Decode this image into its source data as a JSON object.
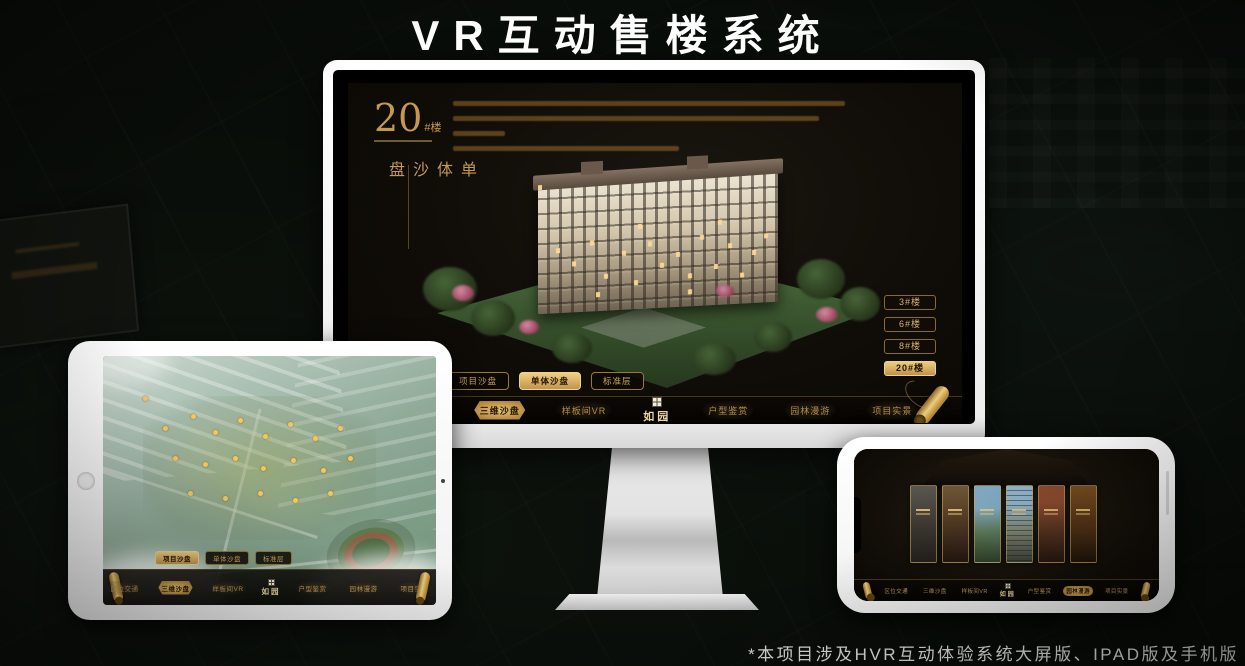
{
  "page": {
    "title": "VR互动售楼系统",
    "footnote": "*本项目涉及HVR互动体验系统大屏版、IPAD版及手机版"
  },
  "brand": {
    "logo": "如园",
    "gold": "#d9b267",
    "screen_bg": "#100d08"
  },
  "nav": {
    "items": [
      {
        "label": "区位交通"
      },
      {
        "label": "三维沙盘"
      },
      {
        "label": "样板间VR"
      },
      {
        "label": "户型鉴赏"
      },
      {
        "label": "园林漫游"
      },
      {
        "label": "项目实景"
      }
    ]
  },
  "sub_tabs": {
    "items": [
      {
        "label": "项目沙盘"
      },
      {
        "label": "单体沙盘"
      },
      {
        "label": "标准层"
      }
    ]
  },
  "monitor": {
    "header": {
      "number": "20",
      "unit": "#楼",
      "title_vertical": "单体沙盘"
    },
    "floor_buttons": [
      {
        "label": "3#楼",
        "active": false
      },
      {
        "label": "6#楼",
        "active": false
      },
      {
        "label": "8#楼",
        "active": false
      },
      {
        "label": "20#楼",
        "active": true
      }
    ],
    "active_sub_tab": "单体沙盘",
    "active_nav": "三维沙盘"
  },
  "ipad": {
    "active_sub_tab": "项目沙盘",
    "active_nav": "三维沙盘"
  },
  "phone": {
    "active_nav": "园林漫游",
    "strip_count": 6
  }
}
